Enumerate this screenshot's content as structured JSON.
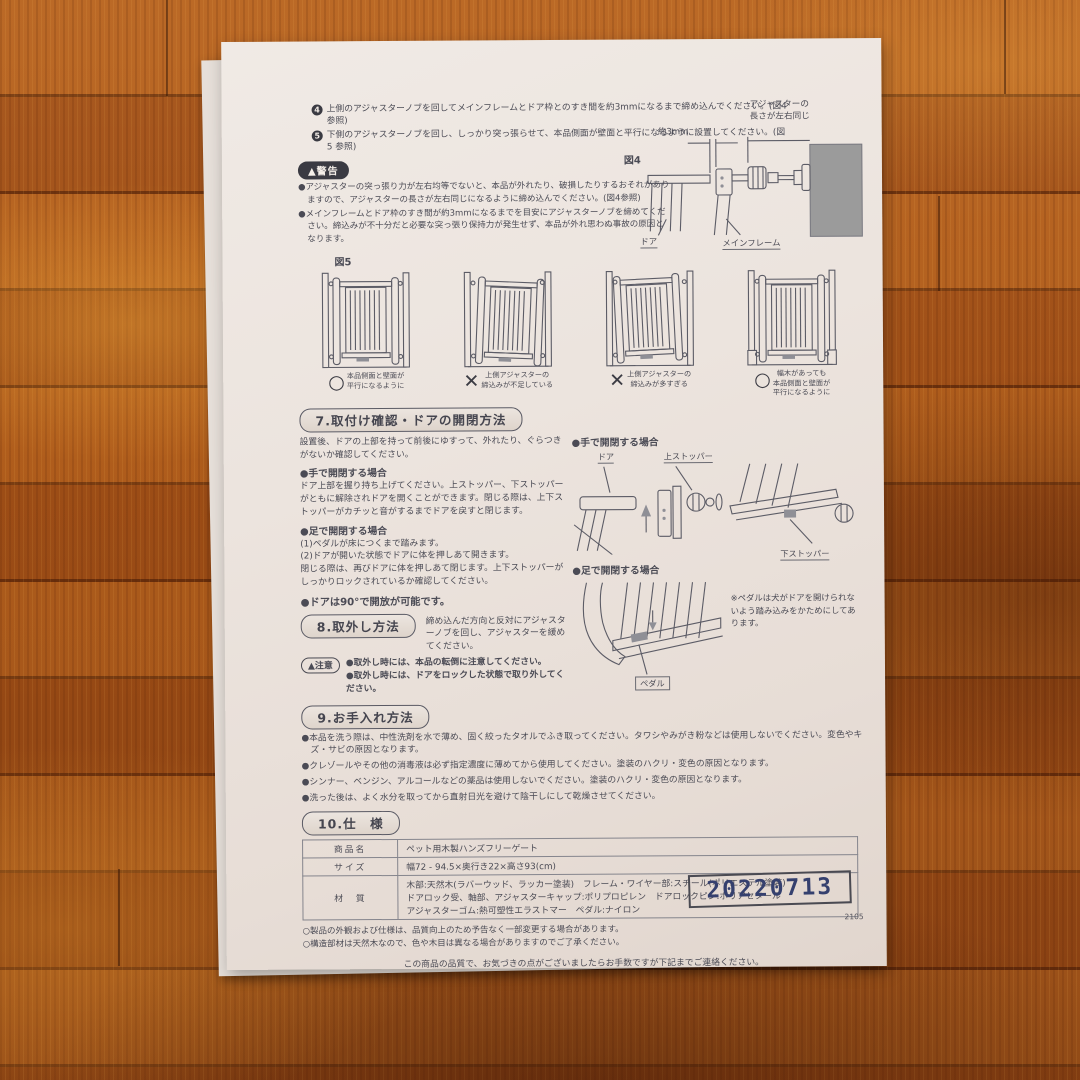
{
  "steps": [
    {
      "num": "4",
      "text": "上側のアジャスターノブを回してメインフレームとドア枠とのすき間を約3mmになるまで締め込んでください。(図4 参照)"
    },
    {
      "num": "5",
      "text": "下側のアジャスターノブを回し、しっかり突っ張らせて、本品側面が壁面と平行になるように設置してください。(図5 参照)"
    }
  ],
  "warning": {
    "label": "▲警告",
    "bullets": [
      "●アジャスターの突っ張り力が左右均等でないと、本品が外れたり、破損したりするおそれがありますので、アジャスターの長さが左右同じになるように締め込んでください。(図4参照)",
      "●メインフレームとドア枠のすき間が約3mmになるまでを目安にアジャスターノブを締めてください。締込みが不十分だと必要な突っ張り保持力が発生せず、本品が外れ思わぬ事故の原因となります。"
    ]
  },
  "fig4": {
    "label": "図4",
    "dim": "約3mm",
    "note": "アジャスターの\n長さが左右同じ",
    "door_label": "ドア",
    "mainframe_label": "メインフレーム"
  },
  "fig5": {
    "label": "図5",
    "items": [
      {
        "mark": "○",
        "caption": "本品側面と壁面が\n平行になるように"
      },
      {
        "mark": "✕",
        "caption": "上側アジャスターの\n締込みが不足している"
      },
      {
        "mark": "✕",
        "caption": "上側アジャスターの\n締込みが多すぎる"
      },
      {
        "mark": "○",
        "caption": "幅木があっても\n本品側面と壁面が\n平行になるように"
      }
    ]
  },
  "sec7": {
    "title": "7.取付け確認・ドアの開閉方法",
    "intro": "設置後、ドアの上部を持って前後にゆすって、外れたり、ぐらつきがないか確認してください。",
    "hand_heading": "●手で開閉する場合",
    "hand_text": "ドア上部を握り持ち上げてください。上ストッパー、下ストッパーがともに解除されドアを開くことができます。閉じる際は、上下ストッパーがカチッと音がするまでドアを戻すと閉じます。",
    "foot_heading": "●足で開閉する場合",
    "foot_lines": [
      "(1)ペダルが床につくまで踏みます。",
      "(2)ドアが開いた状態でドアに体を押しあて開きます。",
      "閉じる際は、再びドアに体を押しあて閉じます。上下ストッパーがしっかりロックされているか確認してください。"
    ],
    "door90": "●ドアは90°で開放が可能です。",
    "labels": {
      "door": "ドア",
      "top_stopper": "上ストッパー",
      "bottom_stopper": "下ストッパー",
      "pedal": "ペダル"
    },
    "pedal_note": "※ペダルは犬がドアを開けられないよう踏み込みをかためにしてあります。"
  },
  "sec8": {
    "title": "8.取外し方法",
    "text": "締め込んだ方向と反対にアジャスターノブを回し、アジャスターを緩めてください。",
    "caution_label": "▲注意",
    "caution_bullets": [
      "●取外し時には、本品の転倒に注意してください。",
      "●取外し時には、ドアをロックした状態で取り外してください。"
    ]
  },
  "sec9": {
    "title": "9.お手入れ方法",
    "bullets": [
      "●本品を洗う際は、中性洗剤を水で薄め、固く絞ったタオルでふき取ってください。タワシやみがき粉などは使用しないでください。変色やキズ・サビの原因となります。",
      "●クレゾールやその他の消毒液は必ず指定濃度に薄めてから使用してください。塗装のハクリ・変色の原因となります。",
      "●シンナー、ベンジン、アルコールなどの薬品は使用しないでください。塗装のハクリ・変色の原因となります。",
      "●洗った後は、よく水分を取ってから直射日光を避けて陰干しにして乾燥させてください。"
    ]
  },
  "sec10": {
    "title": "10.仕　様",
    "rows": [
      {
        "k": "商品名",
        "v": "ペット用木製ハンズフリーゲート"
      },
      {
        "k": "サイズ",
        "v": "幅72 - 94.5×奥行き22×高さ93(cm)"
      },
      {
        "k": "材　質",
        "v": "木部:天然木(ラバーウッド、ラッカー塗装)　フレーム・ワイヤー部:スチール(ポリエステル塗装)\nドアロック受、軸部、アジャスターキャップ:ポリプロピレン　ドアロックピン:ポリアセタール\nアジャスターゴム:熱可塑性エラストマー　ペダル:ナイロン"
      }
    ]
  },
  "notes": [
    "○製品の外観および仕様は、品質向上のため予告なく一部変更する場合があります。",
    "○構造部材は天然木なので、色や木目は異なる場合がありますのでご了承ください。"
  ],
  "contact_line": "この商品の品質で、お気づきの点がございましたらお手数ですが下記までご連絡ください。",
  "company": {
    "name": "株式会社 リッチェル",
    "address": "富山市水橋桜木136 〒939-0592　お客様相談室/TEL(076)478-2957",
    "hours": "受付時間:9:00~17:00(土日、祝日を除く)",
    "web": "www.richell.co.jp",
    "designed": "Designed by Richell Corp., Japan",
    "made": "MADE IN VIETNAM",
    "page": "-4-"
  },
  "stamp": {
    "date": "20220713",
    "code": "2105"
  },
  "colors": {
    "stamp_ink": "#35406e",
    "print_ink": "#4b4b55",
    "wall_gray": "#9b9b9b"
  }
}
